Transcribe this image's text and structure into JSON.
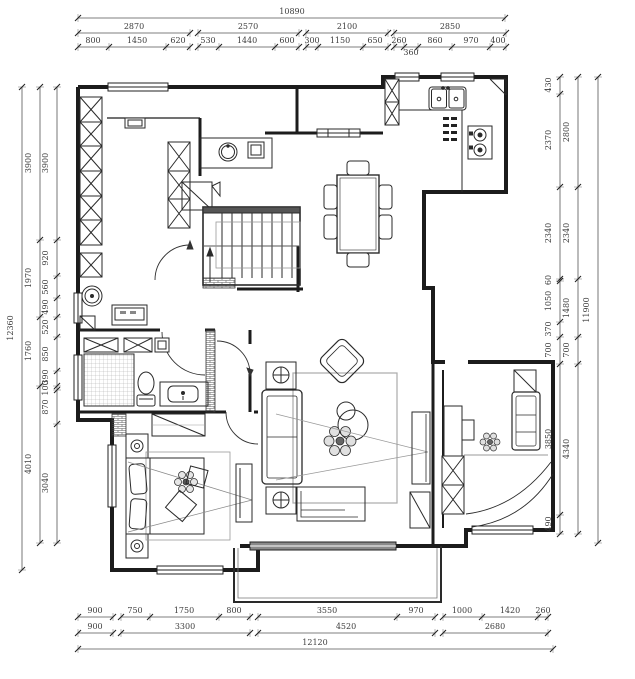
{
  "drawing": {
    "background": "#ffffff",
    "wall_color": "#1c1c1c",
    "furniture_color": "#2a2a2a",
    "dim_color": "#3d3d3d",
    "accent_gray": "#999999"
  },
  "icons": {
    "sink": "double-sink-icon",
    "stove": "gas-stove-icon",
    "toilet": "toilet-icon",
    "shower": "shower-grid-icon",
    "washer": "washing-machine-icon",
    "stairs": "staircase-icon",
    "bed": "double-bed-icon",
    "sofa": "sofa-icon",
    "dining": "dining-table-icon",
    "plant": "plant-decor-icon"
  },
  "dim_chains": [
    {
      "o": "h",
      "pos": 18,
      "ticks": [
        78,
        505
      ],
      "labels": [
        {
          "t": "10890",
          "at": 292
        }
      ]
    },
    {
      "o": "h",
      "pos": 33,
      "ticks": [
        78,
        190
      ],
      "labels": [
        {
          "t": "2870",
          "at": 134
        }
      ]
    },
    {
      "o": "h",
      "pos": 33,
      "ticks": [
        198,
        299
      ],
      "labels": [
        {
          "t": "2570",
          "at": 248
        }
      ]
    },
    {
      "o": "h",
      "pos": 33,
      "ticks": [
        306,
        388
      ],
      "labels": [
        {
          "t": "2100",
          "at": 347
        }
      ]
    },
    {
      "o": "h",
      "pos": 33,
      "ticks": [
        394,
        506
      ],
      "labels": [
        {
          "t": "2850",
          "at": 450
        }
      ]
    },
    {
      "o": "h",
      "pos": 47,
      "ticks": [
        78,
        109,
        166,
        190
      ],
      "labels": [
        {
          "t": "800",
          "at": 93
        },
        {
          "t": "1450",
          "at": 137
        },
        {
          "t": "620",
          "at": 178
        }
      ]
    },
    {
      "o": "h",
      "pos": 47,
      "ticks": [
        198,
        219,
        275,
        299
      ],
      "labels": [
        {
          "t": "530",
          "at": 208
        },
        {
          "t": "1440",
          "at": 247
        },
        {
          "t": "600",
          "at": 287
        }
      ]
    },
    {
      "o": "h",
      "pos": 47,
      "ticks": [
        306,
        318,
        363,
        388
      ],
      "labels": [
        {
          "t": "300",
          "at": 312
        },
        {
          "t": "1150",
          "at": 340
        },
        {
          "t": "650",
          "at": 375
        }
      ]
    },
    {
      "o": "h",
      "pos": 47,
      "ticks": [
        394,
        404,
        418,
        452,
        490,
        506
      ],
      "labels": [
        {
          "t": "260",
          "at": 399
        },
        {
          "t": "360",
          "at": 411,
          "below": true
        },
        {
          "t": "860",
          "at": 435
        },
        {
          "t": "970",
          "at": 471
        },
        {
          "t": "400",
          "at": 498
        }
      ]
    },
    {
      "o": "h",
      "pos": 617,
      "ticks": [
        78,
        113
      ],
      "labels": [
        {
          "t": "900",
          "at": 95
        }
      ]
    },
    {
      "o": "h",
      "pos": 617,
      "ticks": [
        121,
        150,
        219,
        250
      ],
      "labels": [
        {
          "t": "750",
          "at": 135
        },
        {
          "t": "1750",
          "at": 184
        },
        {
          "t": "800",
          "at": 234
        }
      ]
    },
    {
      "o": "h",
      "pos": 617,
      "ticks": [
        258,
        397,
        435
      ],
      "labels": [
        {
          "t": "3550",
          "at": 327
        },
        {
          "t": "970",
          "at": 416
        }
      ]
    },
    {
      "o": "h",
      "pos": 617,
      "ticks": [
        443,
        482,
        538,
        548
      ],
      "labels": [
        {
          "t": "1000",
          "at": 462
        },
        {
          "t": "1420",
          "at": 510
        },
        {
          "t": "260",
          "at": 543
        }
      ]
    },
    {
      "o": "h",
      "pos": 633,
      "ticks": [
        78,
        113
      ],
      "labels": [
        {
          "t": "900",
          "at": 95
        }
      ]
    },
    {
      "o": "h",
      "pos": 633,
      "ticks": [
        121,
        250
      ],
      "labels": [
        {
          "t": "3300",
          "at": 185
        }
      ]
    },
    {
      "o": "h",
      "pos": 633,
      "ticks": [
        258,
        435
      ],
      "labels": [
        {
          "t": "4520",
          "at": 346
        }
      ]
    },
    {
      "o": "h",
      "pos": 633,
      "ticks": [
        443,
        548
      ],
      "labels": [
        {
          "t": "2680",
          "at": 495
        }
      ]
    },
    {
      "o": "h",
      "pos": 649,
      "ticks": [
        78,
        553
      ],
      "labels": [
        {
          "t": "12120",
          "at": 315
        }
      ]
    },
    {
      "o": "v",
      "pos": 22,
      "ticks": [
        87,
        570
      ],
      "labels": [
        {
          "t": "12360",
          "at": 328
        }
      ]
    },
    {
      "o": "v",
      "pos": 40,
      "ticks": [
        87,
        240,
        317,
        386,
        543
      ],
      "labels": [
        {
          "t": "3900",
          "at": 163
        },
        {
          "t": "1970",
          "at": 278
        },
        {
          "t": "1760",
          "at": 351
        },
        {
          "t": "4010",
          "at": 464
        }
      ]
    },
    {
      "o": "v",
      "pos": 57,
      "ticks": [
        87,
        240,
        276,
        298,
        317,
        337,
        371,
        386,
        390,
        424,
        543
      ],
      "labels": [
        {
          "t": "3900",
          "at": 163
        },
        {
          "t": "920",
          "at": 258
        },
        {
          "t": "560",
          "at": 287
        },
        {
          "t": "490",
          "at": 307
        },
        {
          "t": "520",
          "at": 327
        },
        {
          "t": "850",
          "at": 354
        },
        {
          "t": "390",
          "at": 377
        },
        {
          "t": "100",
          "at": 388
        },
        {
          "t": "870",
          "at": 407
        },
        {
          "t": "3040",
          "at": 483
        }
      ]
    },
    {
      "o": "v",
      "pos": 560,
      "ticks": [
        77,
        94,
        187,
        279,
        281,
        322,
        337,
        364,
        515,
        534
      ],
      "labels": [
        {
          "t": "430",
          "at": 85
        },
        {
          "t": "2370",
          "at": 140
        },
        {
          "t": "2340",
          "at": 233
        },
        {
          "t": "60",
          "at": 280
        },
        {
          "t": "1050",
          "at": 301
        },
        {
          "t": "370",
          "at": 329
        },
        {
          "t": "700",
          "at": 350
        },
        {
          "t": "3850",
          "at": 439
        },
        {
          "t": "490",
          "at": 524
        }
      ]
    },
    {
      "o": "v",
      "pos": 578,
      "ticks": [
        77,
        187,
        279,
        337,
        364,
        534
      ],
      "labels": [
        {
          "t": "2800",
          "at": 132
        },
        {
          "t": "2340",
          "at": 233
        },
        {
          "t": "1480",
          "at": 308
        },
        {
          "t": "700",
          "at": 350
        },
        {
          "t": "4340",
          "at": 449
        }
      ]
    },
    {
      "o": "v",
      "pos": 598,
      "ticks": [
        77,
        543
      ],
      "labels": [
        {
          "t": "11900",
          "at": 310
        }
      ]
    }
  ]
}
